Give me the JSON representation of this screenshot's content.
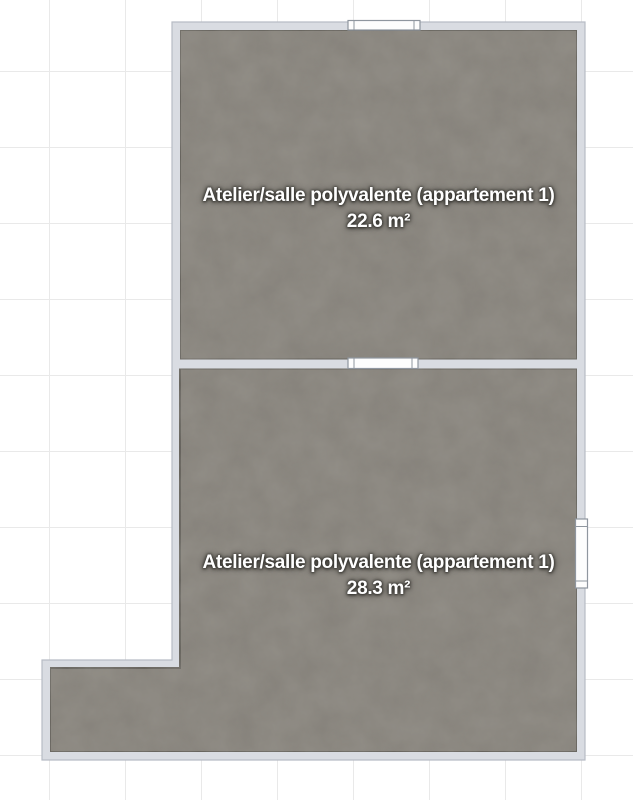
{
  "plan": {
    "rooms": [
      {
        "name": "Atelier/salle polyvalente (appartement 1)",
        "area": "22.6 m²"
      },
      {
        "name": "Atelier/salle polyvalente (appartement 1)",
        "area": "28.3 m²"
      }
    ]
  },
  "colors": {
    "background": "#ffffff",
    "grid_line": "#e9e9e9",
    "wall_fill": "#d9dce2",
    "wall_edge": "#b7bcc5",
    "floor_fill": "#86827a",
    "floor_edge": "#605d57",
    "label_text": "#ffffff",
    "label_glow": "#33312d",
    "window_fill": "#fdfdfd",
    "window_border": "#8f969f"
  }
}
